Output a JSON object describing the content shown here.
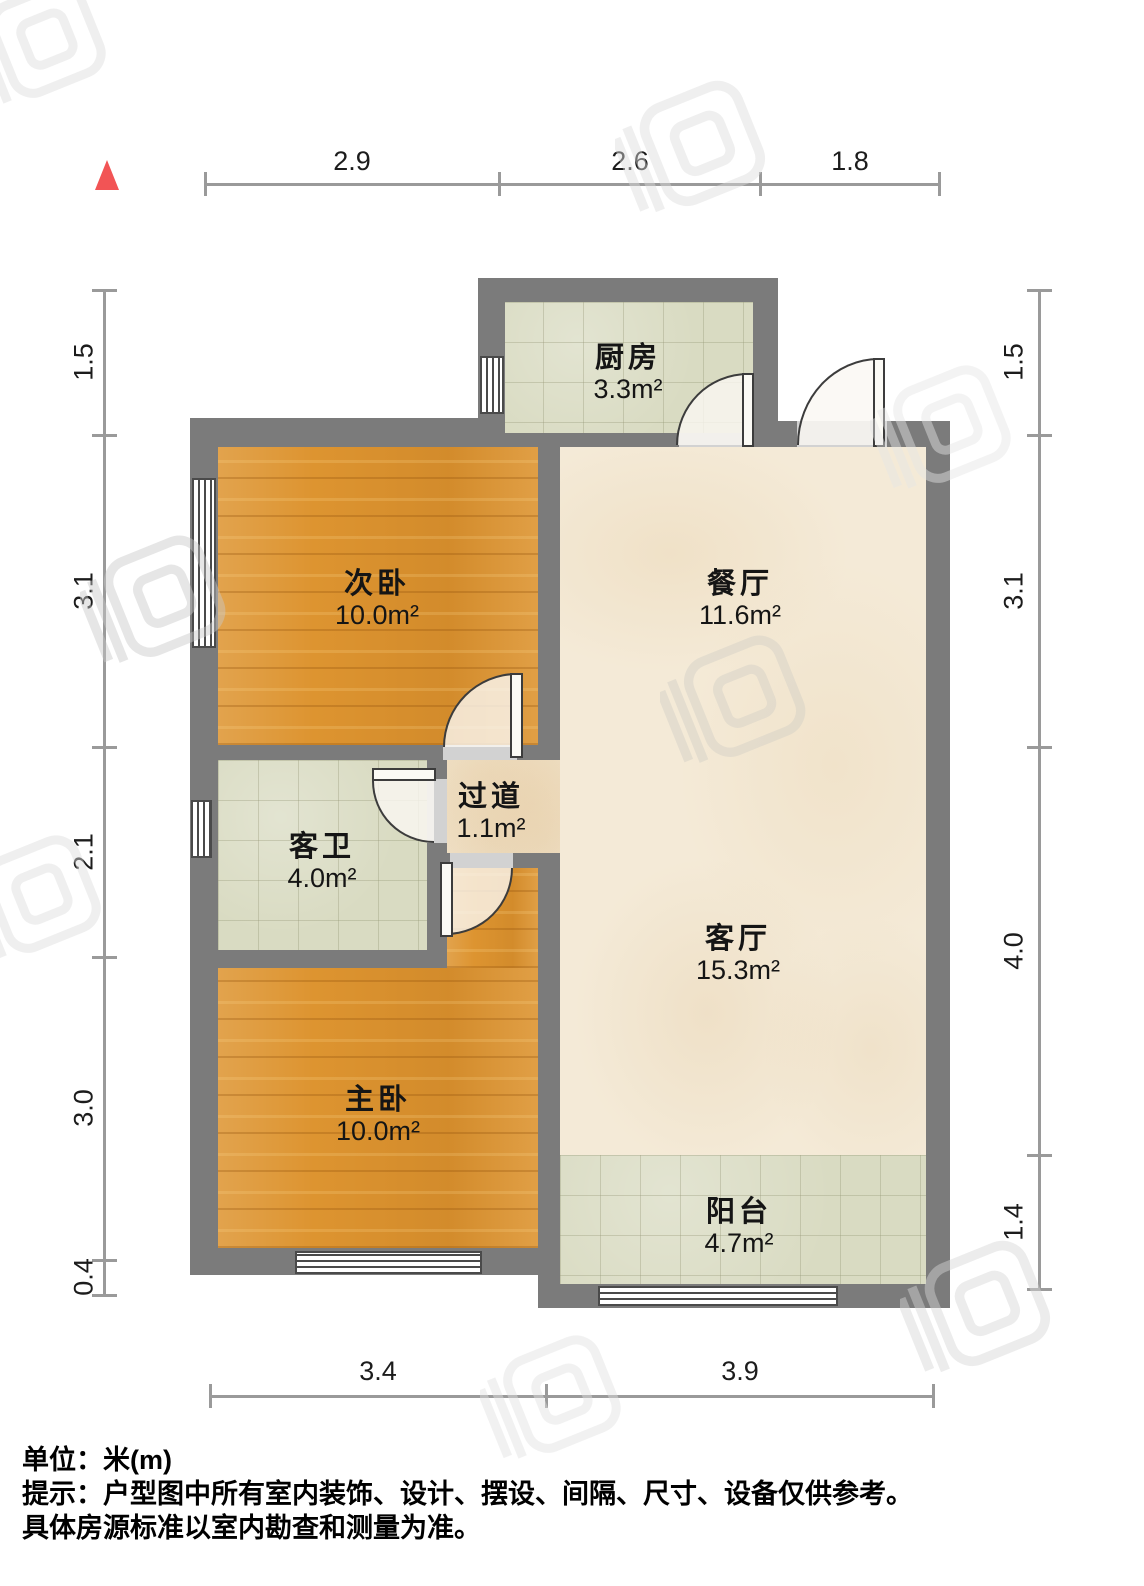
{
  "rooms": {
    "kitchen": {
      "name": "厨房",
      "area": "3.3m²"
    },
    "second_bedroom": {
      "name": "次卧",
      "area": "10.0m²"
    },
    "dining": {
      "name": "餐厅",
      "area": "11.6m²"
    },
    "bathroom": {
      "name": "客卫",
      "area": "4.0m²"
    },
    "hallway": {
      "name": "过道",
      "area": "1.1m²"
    },
    "living": {
      "name": "客厅",
      "area": "15.3m²"
    },
    "master_bedroom": {
      "name": "主卧",
      "area": "10.0m²"
    },
    "balcony": {
      "name": "阳台",
      "area": "4.7m²"
    }
  },
  "dimensions": {
    "top": [
      "2.9",
      "2.6",
      "1.8"
    ],
    "bottom": [
      "3.4",
      "3.9"
    ],
    "left": [
      "1.5",
      "3.1",
      "2.1",
      "3.0",
      "0.4"
    ],
    "right": [
      "1.5",
      "3.1",
      "4.0",
      "1.4"
    ]
  },
  "notes": {
    "unit": "单位：米(m)",
    "tip_line1": "提示：户型图中所有室内装饰、设计、摆设、间隔、尺寸、设备仅供参考。",
    "tip_line2": "具体房源标准以室内勘查和测量为准。"
  },
  "colors": {
    "wall": "#7b7b7b",
    "wood_floor": "#dd9430",
    "tile_floor": "#d9dbc2",
    "marble_floor": "#f4ead7",
    "north_arrow": "#f25455",
    "dimension_line": "#9a9a9a"
  },
  "icons": {
    "north_arrow": "north-triangle",
    "watermark": "logo-watermark"
  }
}
